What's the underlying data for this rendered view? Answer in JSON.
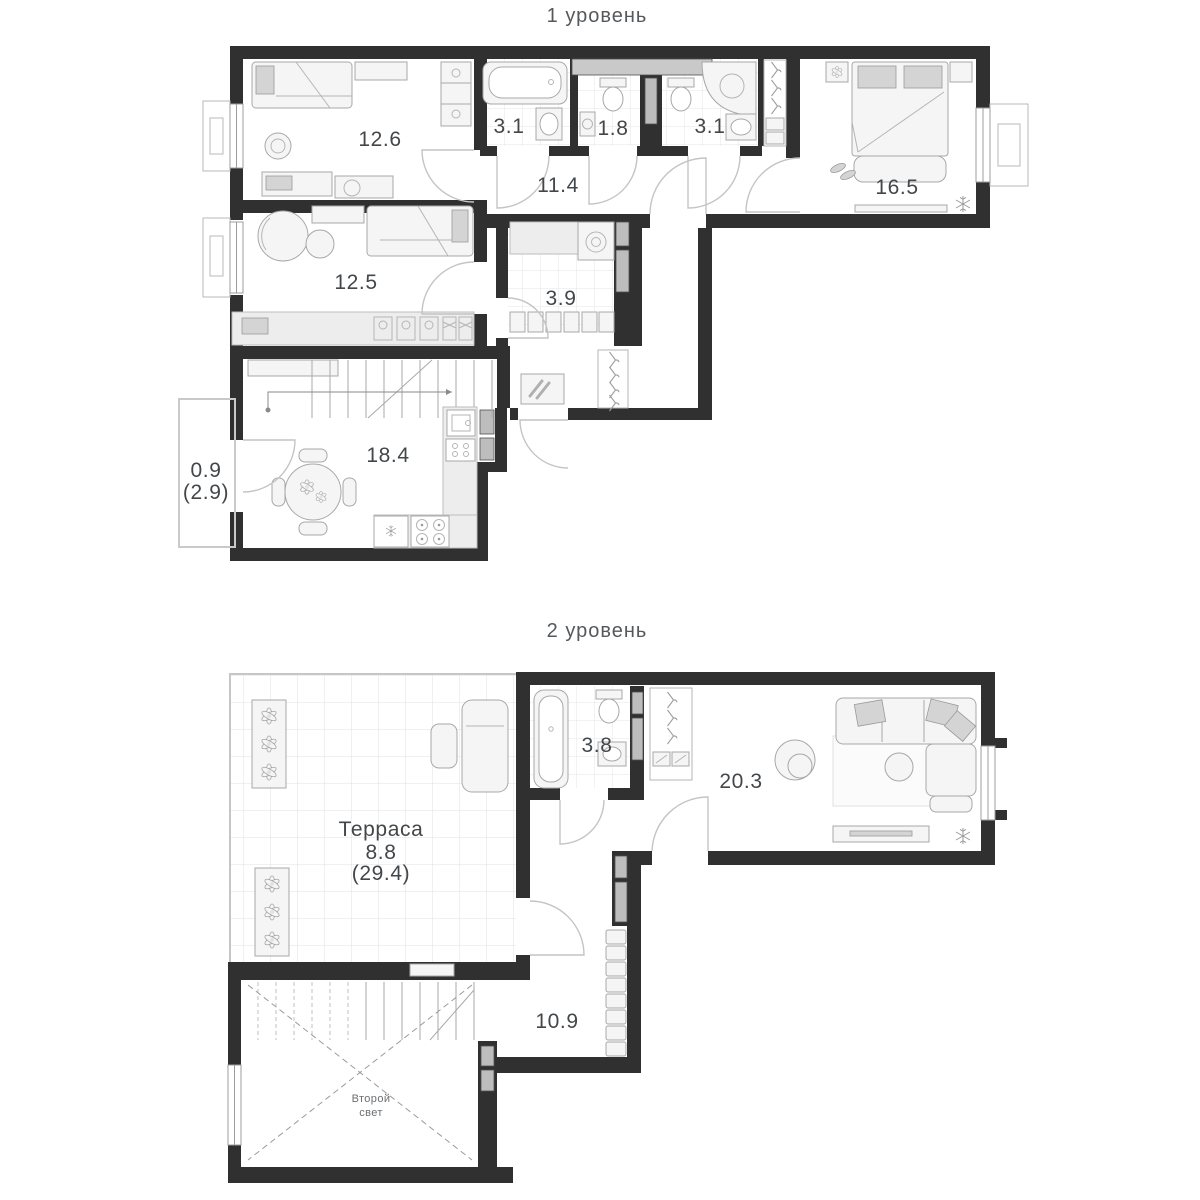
{
  "palette": {
    "wall": "#303030",
    "label_text": "#43474a",
    "title_text": "#55595c",
    "furniture_stroke": "#a8a8a8",
    "tile_line": "#e4e4e4",
    "door_arc": "#c4c4c4",
    "shaft_fill": "#bdbdbd"
  },
  "levels": [
    {
      "title": "1 уровень",
      "rooms": [
        {
          "id": "child-room-1",
          "area": "12.6"
        },
        {
          "id": "bathroom-left",
          "area": "3.1"
        },
        {
          "id": "wc",
          "area": "1.8"
        },
        {
          "id": "bathroom-right",
          "area": "3.1"
        },
        {
          "id": "bedroom",
          "area": "16.5"
        },
        {
          "id": "hallway",
          "area": "11.4"
        },
        {
          "id": "child-room-2",
          "area": "12.5"
        },
        {
          "id": "laundry",
          "area": "3.9"
        },
        {
          "id": "kitchen-living",
          "area": "18.4"
        },
        {
          "id": "balcony",
          "area": "0.9",
          "area_total": "(2.9)"
        }
      ]
    },
    {
      "title": "2 уровень",
      "rooms": [
        {
          "id": "terrace",
          "name": "Терраса",
          "area": "8.8",
          "area_total": "(29.4)"
        },
        {
          "id": "bathroom",
          "area": "3.8"
        },
        {
          "id": "living-room",
          "area": "20.3"
        },
        {
          "id": "hall",
          "area": "10.9"
        },
        {
          "id": "void",
          "name_line1": "Второй",
          "name_line2": "свет"
        }
      ]
    }
  ]
}
